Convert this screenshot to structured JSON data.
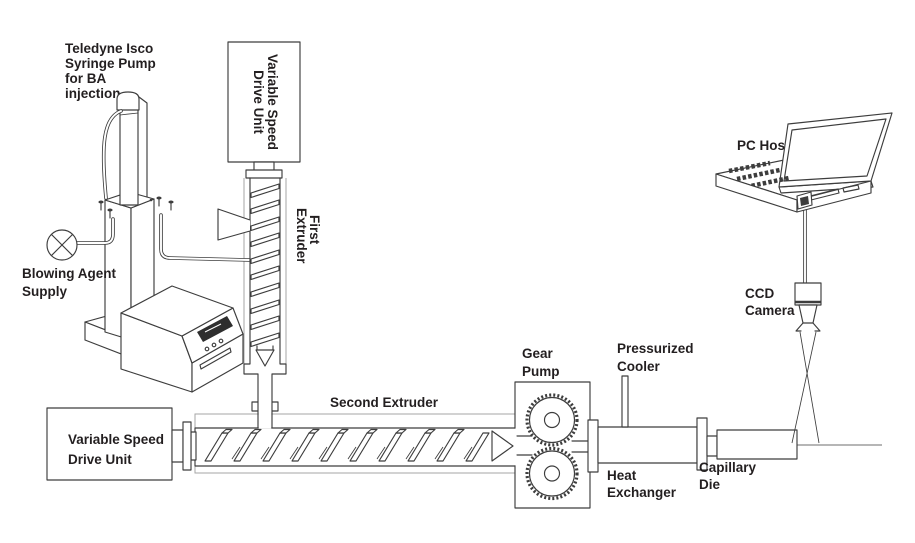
{
  "diagram": {
    "colors": {
      "line": "#3d3d3d",
      "light_line": "#a6a6a6",
      "label": "#231f20",
      "display": "#2e2e2e",
      "background": "#ffffff"
    },
    "labels": {
      "syringe_pump": [
        "Teledyne Isco",
        "Syringe Pump",
        "for BA",
        "injection"
      ],
      "blowing_agent": [
        "Blowing Agent",
        "Supply"
      ],
      "vsd_first": [
        "Variable Speed",
        "Drive Unit"
      ],
      "first_extruder": [
        "First",
        "Extruder"
      ],
      "vsd_second": [
        "Variable Speed",
        "Drive Unit"
      ],
      "second_extruder": [
        "Second Extruder"
      ],
      "gear_pump": [
        "Gear",
        "Pump"
      ],
      "pressurized_cooler": [
        "Pressurized",
        "Cooler"
      ],
      "heat_exchanger": [
        "Heat",
        "Exchanger"
      ],
      "capillary_die": [
        "Capillary",
        "Die"
      ],
      "pc_host": [
        "PC Host"
      ],
      "ccd_camera": [
        "CCD",
        "Camera"
      ]
    }
  }
}
